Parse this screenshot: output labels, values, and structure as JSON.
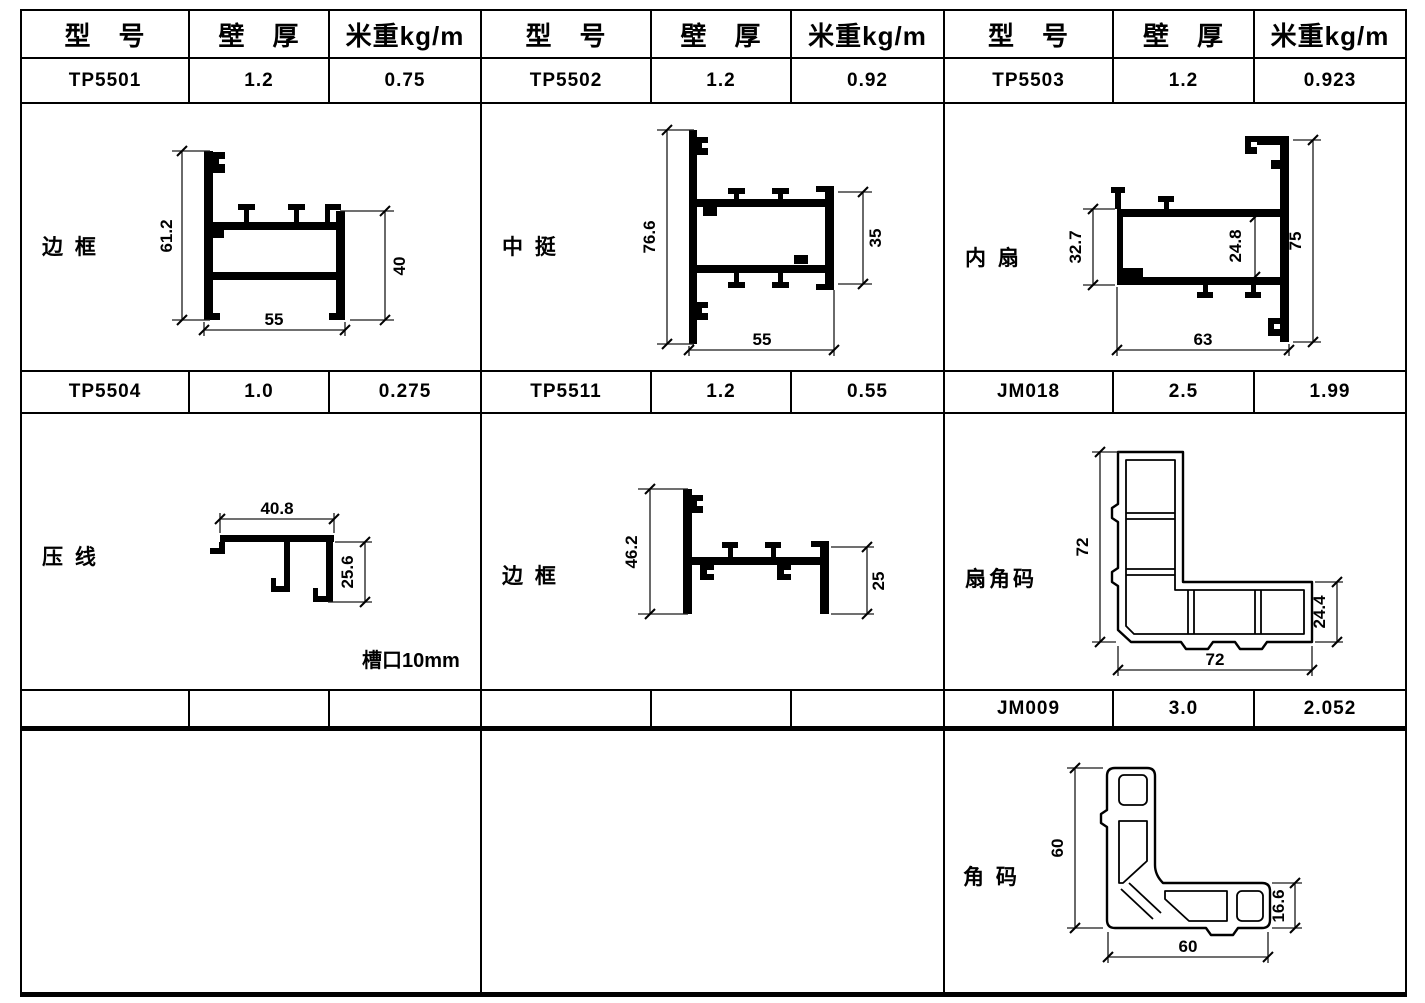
{
  "header": {
    "model": "型　号",
    "wall": "壁　厚",
    "weight": "米重kg/m"
  },
  "groups": {
    "g1": {
      "row1": {
        "model": "TP5501",
        "wall": "1.2",
        "weight": "0.75"
      },
      "d1": {
        "label": "边 框",
        "height": "61.2",
        "right": "40",
        "width": "55"
      },
      "row2": {
        "model": "TP5504",
        "wall": "1.0",
        "weight": "0.275"
      },
      "d2": {
        "label": "压 线",
        "width": "40.8",
        "right": "25.6",
        "note": "槽口10mm"
      },
      "row3": {
        "model": "",
        "wall": "",
        "weight": ""
      }
    },
    "g2": {
      "row1": {
        "model": "TP5502",
        "wall": "1.2",
        "weight": "0.92"
      },
      "d1": {
        "label": "中 挺",
        "height": "76.6",
        "right": "35",
        "width": "55"
      },
      "row2": {
        "model": "TP5511",
        "wall": "1.2",
        "weight": "0.55"
      },
      "d2": {
        "label": "边 框",
        "height": "46.2",
        "right": "25"
      },
      "row3": {
        "model": "",
        "wall": "",
        "weight": ""
      }
    },
    "g3": {
      "row1": {
        "model": "TP5503",
        "wall": "1.2",
        "weight": "0.923"
      },
      "d1": {
        "label": "内 扇",
        "left": "32.7",
        "inner": "24.8",
        "right": "75",
        "width": "63"
      },
      "row2": {
        "model": "JM018",
        "wall": "2.5",
        "weight": "1.99"
      },
      "d2": {
        "label": "扇角码",
        "height": "72",
        "width": "72",
        "right": "24.4"
      },
      "row3": {
        "model": "JM009",
        "wall": "3.0",
        "weight": "2.052"
      },
      "d3": {
        "label": "角 码",
        "height": "60",
        "width": "60",
        "right": "16.6"
      }
    }
  }
}
